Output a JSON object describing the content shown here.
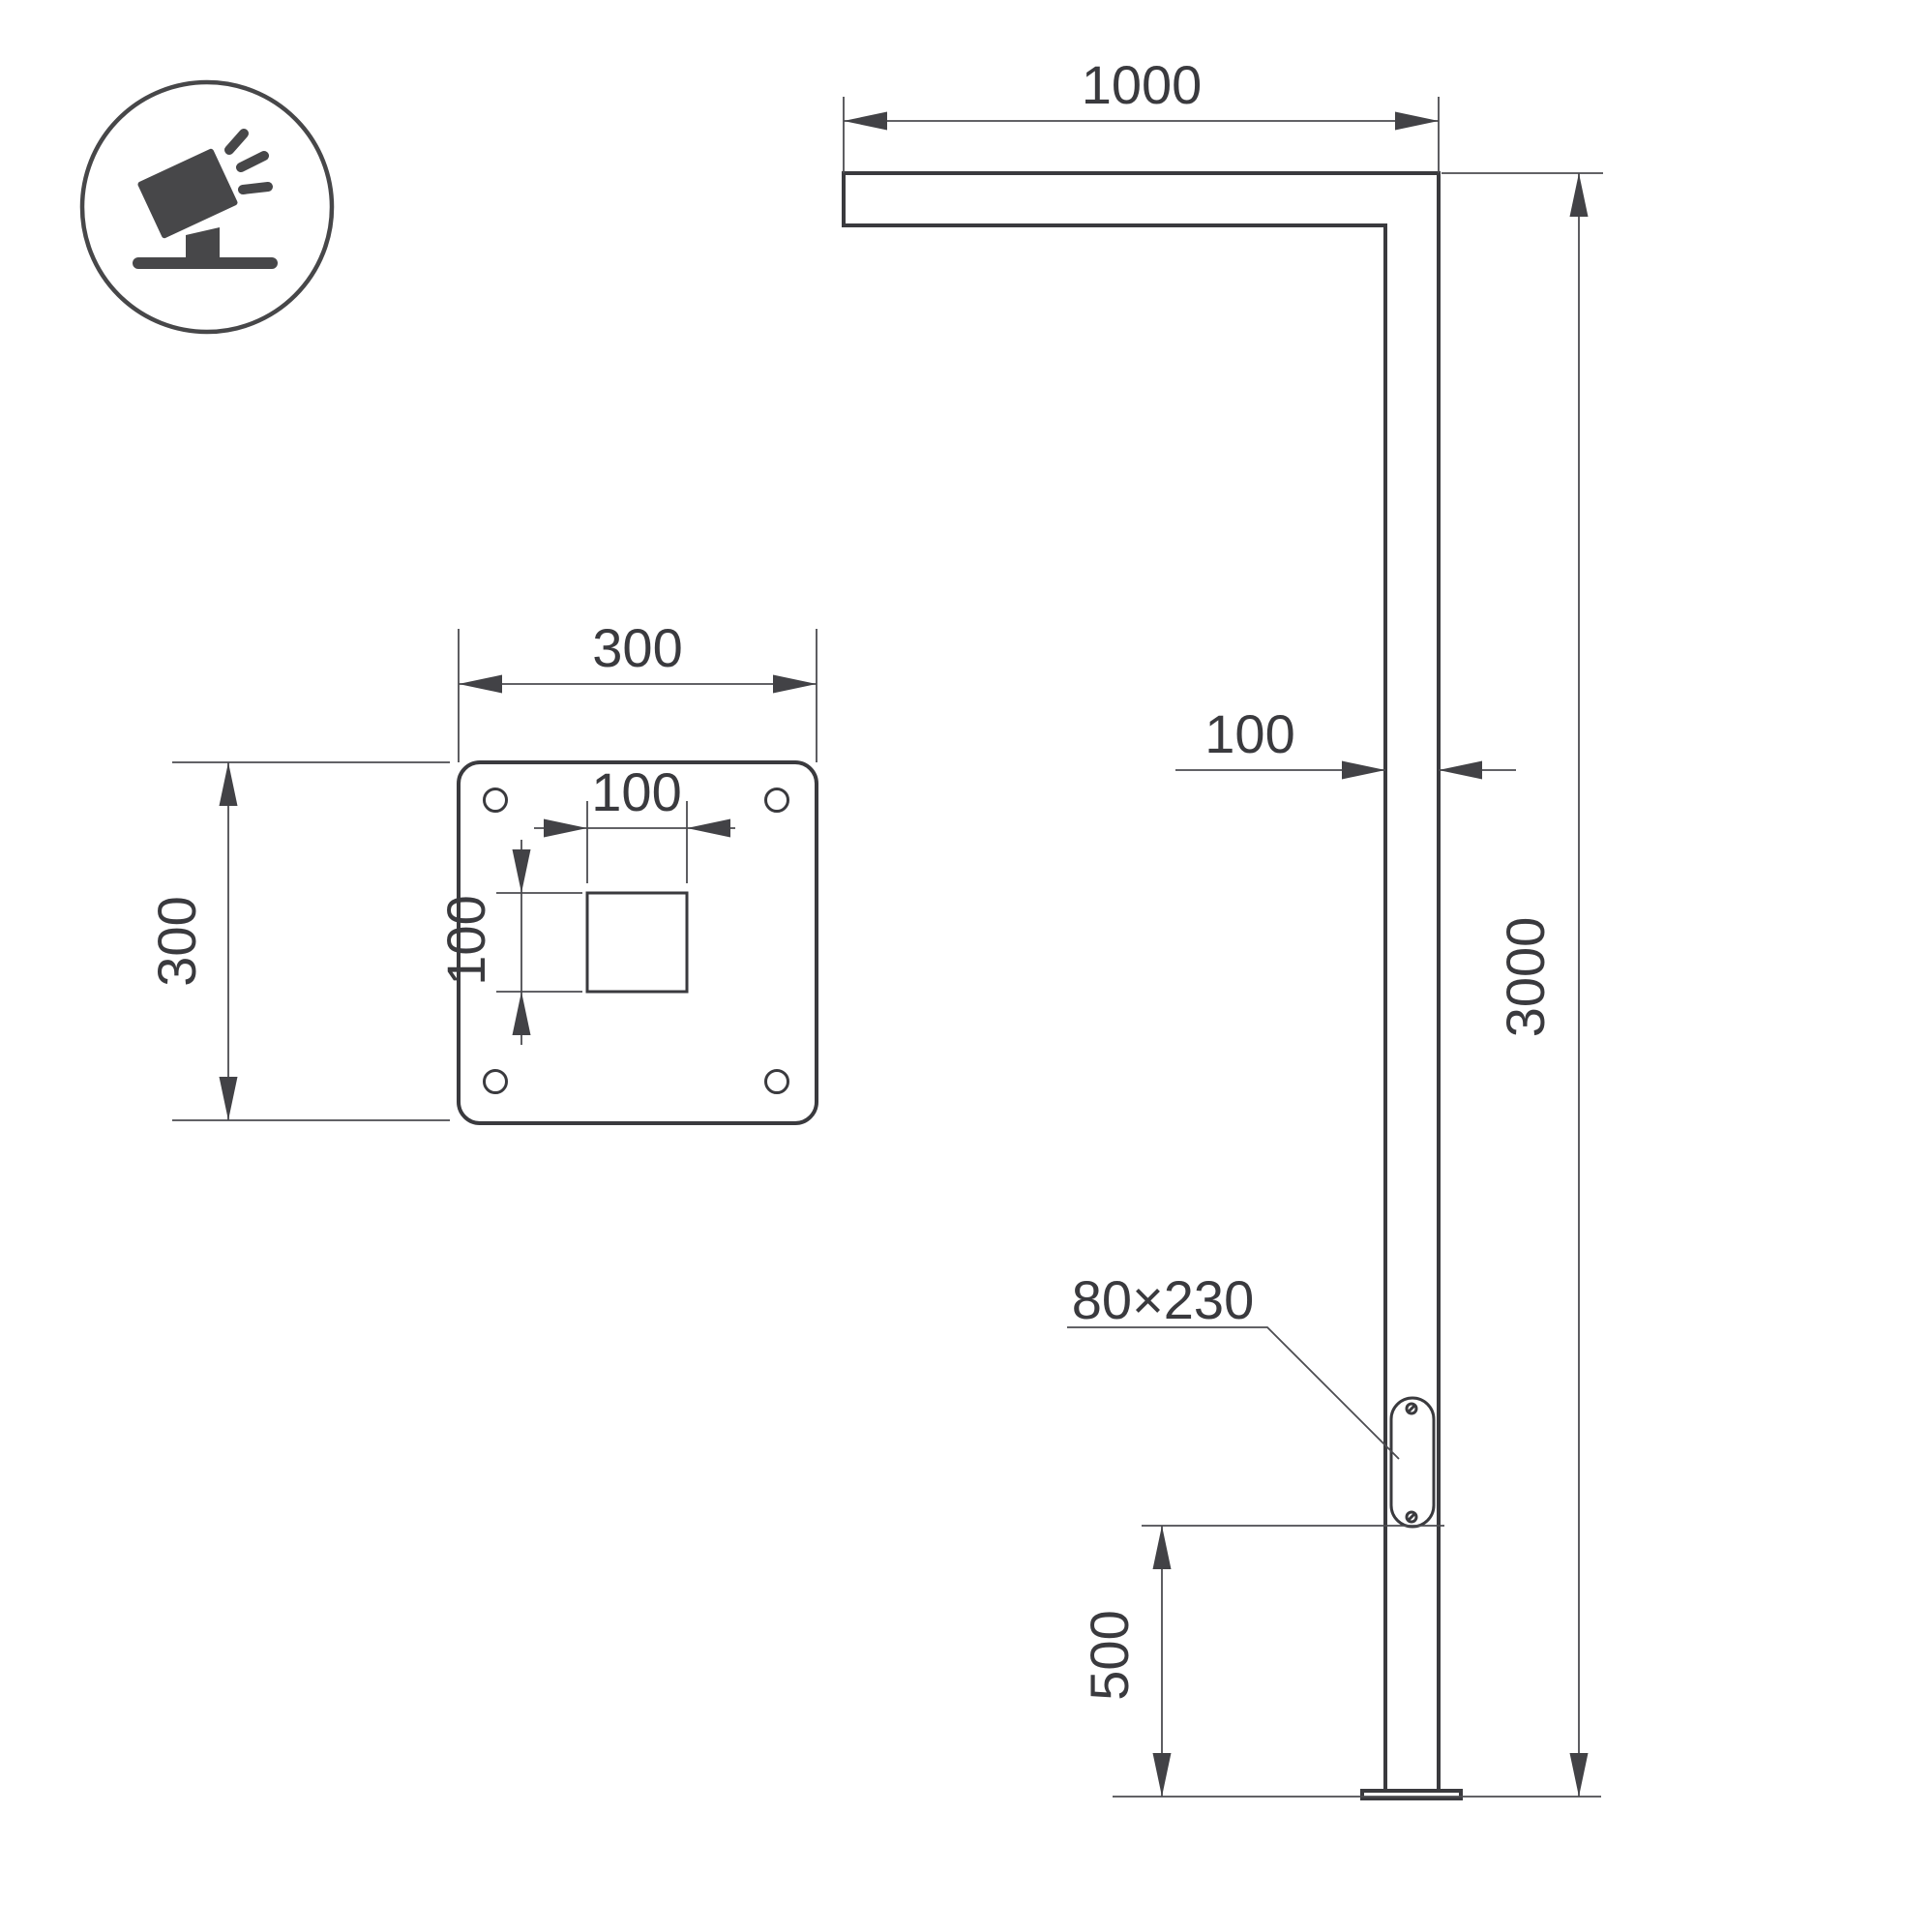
{
  "drawing": {
    "type": "technical-dimension-drawing",
    "background_color": "#ffffff",
    "object_line_color": "#3a3a3e",
    "dimension_line_color": "#4c4c50",
    "icon": {
      "name": "tilted-floodlight-on-stand-icon",
      "shape": "circle-badge"
    },
    "front_view": {
      "arm_length_label": "1000",
      "pole_width_label": "100",
      "pole_height_label": "3000",
      "panel_size_label": "80×230",
      "panel_bottom_height_label": "500"
    },
    "base_plate_view": {
      "plate_width_label": "300",
      "plate_height_label": "300",
      "hole_width_label": "100",
      "hole_height_label": "100"
    }
  }
}
